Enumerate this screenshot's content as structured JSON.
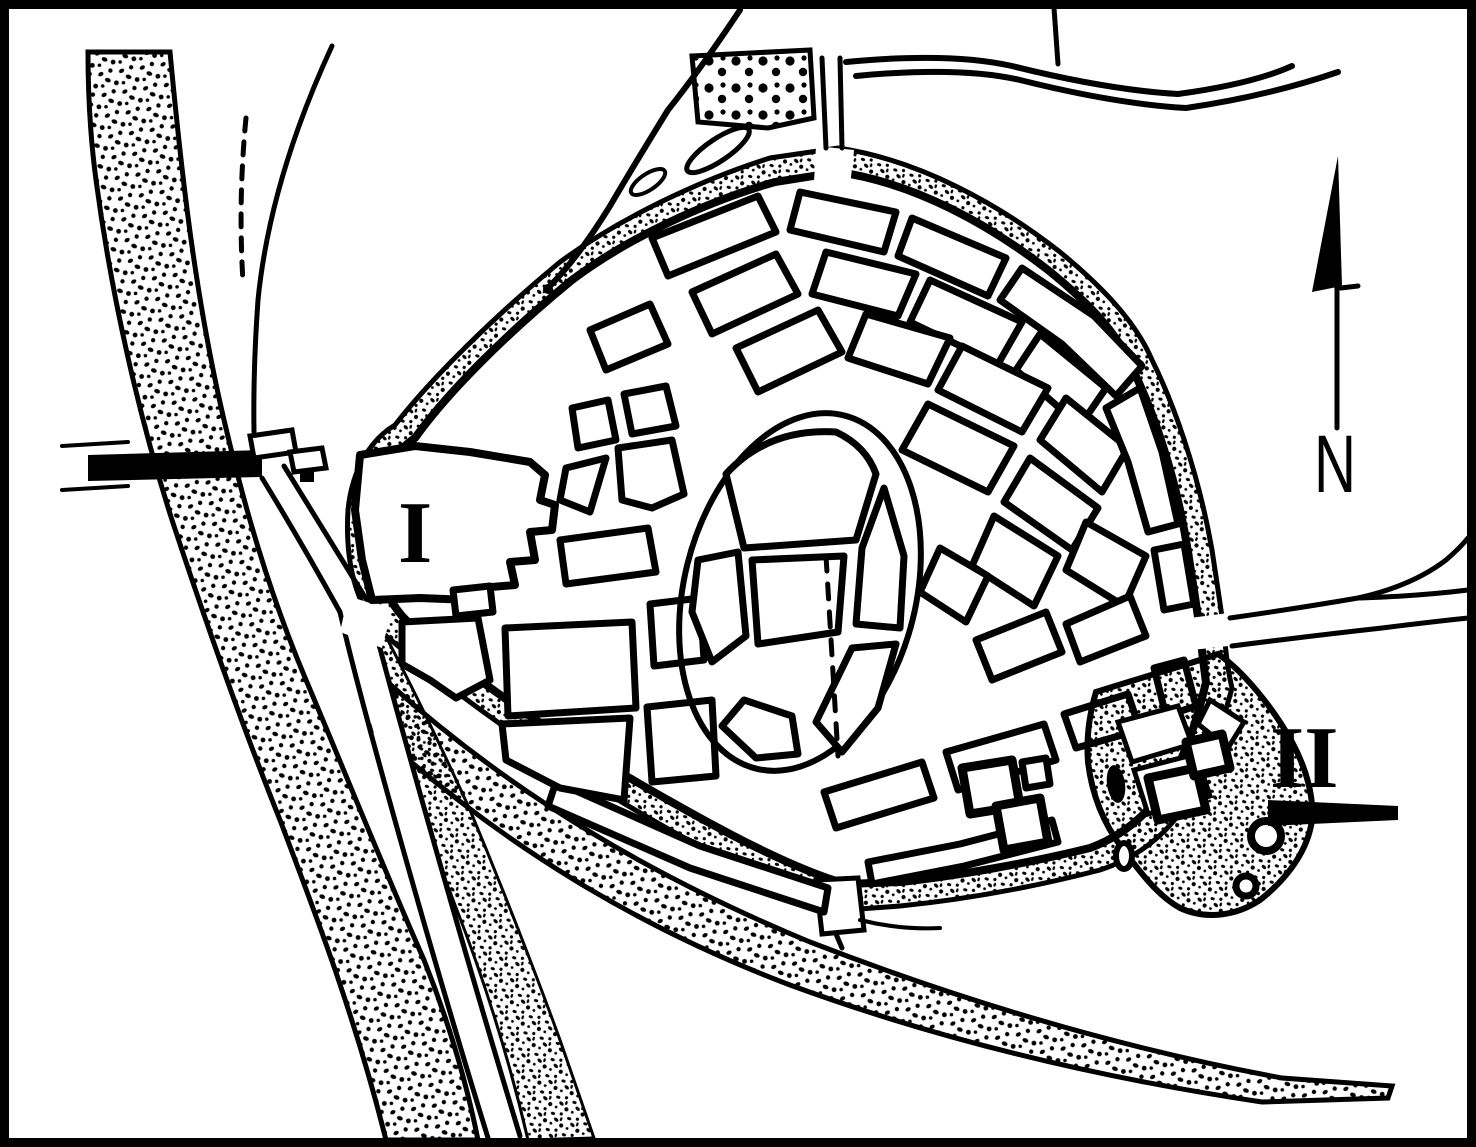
{
  "figure": {
    "kind": "historic-town-plan",
    "labels": {
      "area1": "I",
      "area2": "II",
      "north": "N"
    }
  },
  "legend": {
    "area1_meaning": "western enclosure marked I",
    "area2_meaning": "south-eastern castle complex marked II",
    "north_arrow": "compass needle pointing up"
  },
  "colors": {
    "ink": "#000000",
    "paper": "#ffffff"
  }
}
